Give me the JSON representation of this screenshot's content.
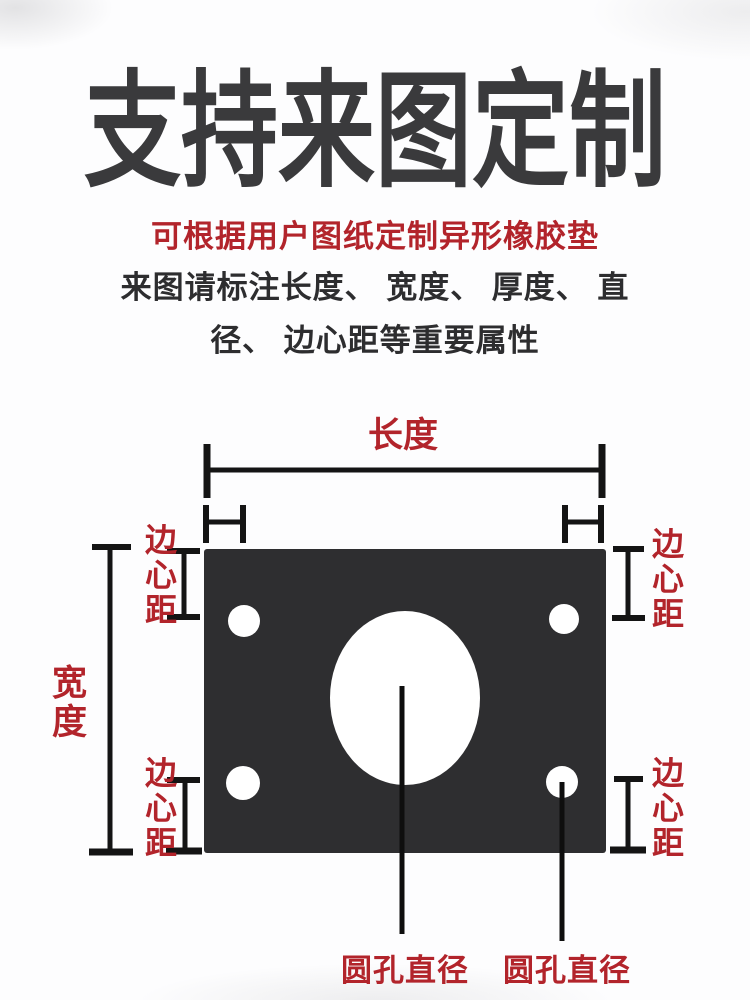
{
  "header": {
    "title": "支持来图定制",
    "subtitle": "可根据用户图纸定制异形橡胶垫",
    "note_line1": "来图请标注长度、 宽度、 厚度、 直",
    "note_line2": "径、 边心距等重要属性"
  },
  "diagram": {
    "length_label": "长度",
    "width_label": "宽度",
    "edge_labels": {
      "top_left": "边心距",
      "top_right": "边心距",
      "bottom_left": "边心距",
      "bottom_right": "边心距"
    },
    "hole_labels": {
      "center_hole": "圆孔直径",
      "corner_hole": "圆孔直径"
    },
    "colors": {
      "accent_red": "#b2242b",
      "plate_dark": "#2e2e30",
      "dimension_line": "#141414",
      "title_gray": "#3a3a3c"
    }
  }
}
